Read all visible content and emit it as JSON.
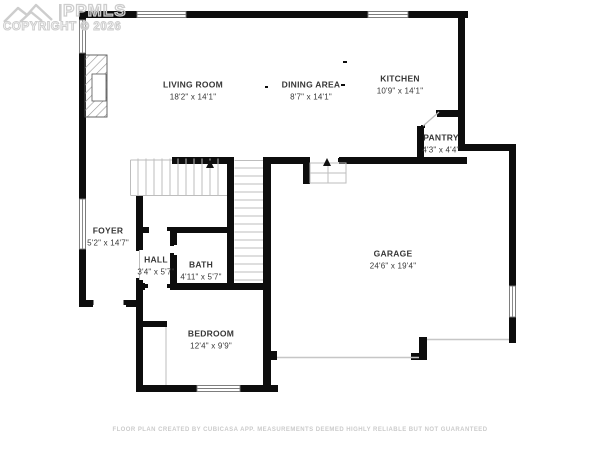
{
  "watermark": {
    "logo_text": "PPMLS",
    "copyright": "COPYRIGHT © 2026",
    "logo_icon": "mountains-icon"
  },
  "rooms": [
    {
      "id": "living-room",
      "name": "LIVING ROOM",
      "dims": "18'2\" x 14'1\""
    },
    {
      "id": "dining-area",
      "name": "DINING AREA",
      "dims": "8'7\" x 14'1\""
    },
    {
      "id": "kitchen",
      "name": "KITCHEN",
      "dims": "10'9\" x 14'1\""
    },
    {
      "id": "pantry",
      "name": "PANTRY",
      "dims": "4'3\" x 4'4\""
    },
    {
      "id": "foyer",
      "name": "FOYER",
      "dims": "5'2\" x 14'7\""
    },
    {
      "id": "hall",
      "name": "HALL",
      "dims": "3'4\" x 5'7\""
    },
    {
      "id": "bath",
      "name": "BATH",
      "dims": "4'11\" x 5'7\""
    },
    {
      "id": "bedroom",
      "name": "BEDROOM",
      "dims": "12'4\" x 9'9\""
    },
    {
      "id": "garage",
      "name": "GARAGE",
      "dims": "24'6\" x 19'4\""
    }
  ],
  "footer": {
    "disclaimer": "FLOOR PLAN CREATED BY CUBICASA APP. MEASUREMENTS DEEMED HIGHLY RELIABLE BUT NOT GUARANTEED"
  },
  "colors": {
    "background": "#ffffff",
    "wall": "#0d0d0d",
    "thin_line": "#bdbdbd",
    "watermark": "#cdcdcd",
    "label_text": "#373737",
    "footer_text": "#cbcbcb"
  }
}
